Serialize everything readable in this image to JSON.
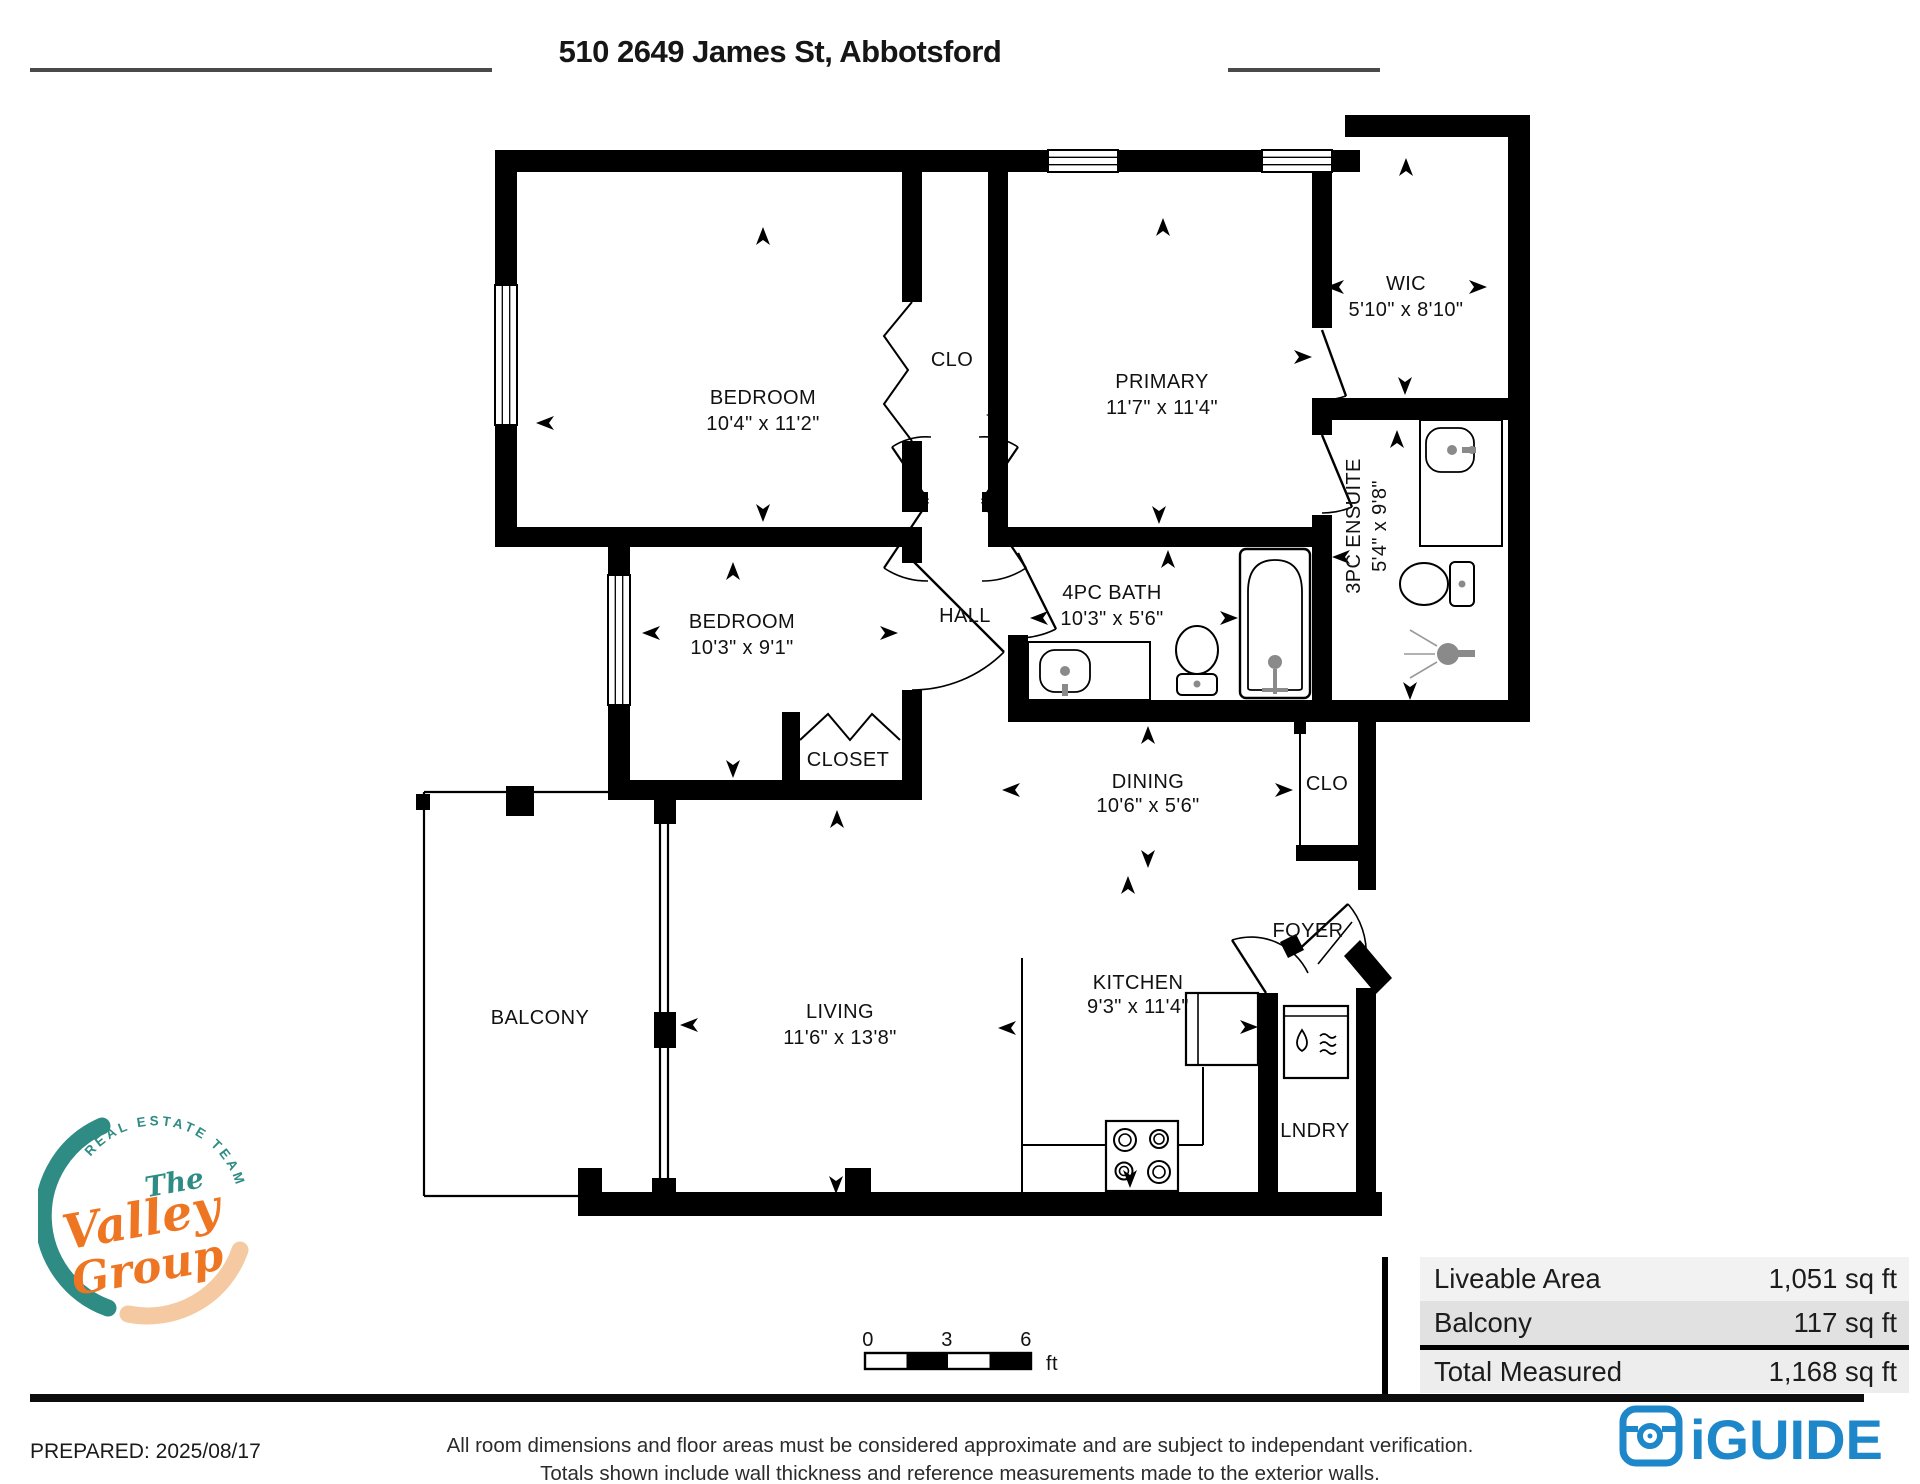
{
  "header": {
    "title": "510 2649 James St, Abbotsford"
  },
  "rooms": [
    {
      "name": "BEDROOM",
      "dims": "10'4\" x 11'2\""
    },
    {
      "name": "CLO",
      "dims": ""
    },
    {
      "name": "PRIMARY",
      "dims": "11'7\" x 11'4\""
    },
    {
      "name": "WIC",
      "dims": "5'10\" x 8'10\""
    },
    {
      "name": "3PC ENSUITE",
      "dims": "5'4\" x 9'8\""
    },
    {
      "name": "BEDROOM",
      "dims": "10'3\" x 9'1\""
    },
    {
      "name": "HALL",
      "dims": ""
    },
    {
      "name": "4PC BATH",
      "dims": "10'3\" x 5'6\""
    },
    {
      "name": "CLOSET",
      "dims": ""
    },
    {
      "name": "DINING",
      "dims": "10'6\" x 5'6\""
    },
    {
      "name": "CLO",
      "dims": ""
    },
    {
      "name": "FOYER",
      "dims": ""
    },
    {
      "name": "BALCONY",
      "dims": ""
    },
    {
      "name": "LIVING",
      "dims": "11'6\" x 13'8\""
    },
    {
      "name": "KITCHEN",
      "dims": "9'3\" x 11'4\""
    },
    {
      "name": "LNDRY",
      "dims": ""
    }
  ],
  "scale": {
    "ticks": [
      "0",
      "3",
      "6"
    ],
    "unit": "ft"
  },
  "areas": {
    "rows": [
      {
        "label": "Liveable Area",
        "value": "1,051 sq ft"
      },
      {
        "label": "Balcony",
        "value": "117 sq ft"
      },
      {
        "label": "Total Measured",
        "value": "1,168 sq ft"
      }
    ]
  },
  "footer": {
    "prepared": "PREPARED: 2025/08/17",
    "line1": "All room dimensions and floor areas must be considered approximate and are subject to independant verification.",
    "line2": "Totals shown include wall thickness and reference measurements made to the exterior walls."
  },
  "branding": {
    "valley": {
      "arc": "REAL ESTATE TEAM",
      "the": "The",
      "word1": "Valley",
      "word2": "Group"
    },
    "iguide": {
      "name": "iGUIDE"
    }
  },
  "colors": {
    "teal": "#2e8c84",
    "orange": "#ee7623",
    "peach": "#f5c9a2",
    "iguide_blue": "#1d87c9",
    "wall": "#000000"
  }
}
